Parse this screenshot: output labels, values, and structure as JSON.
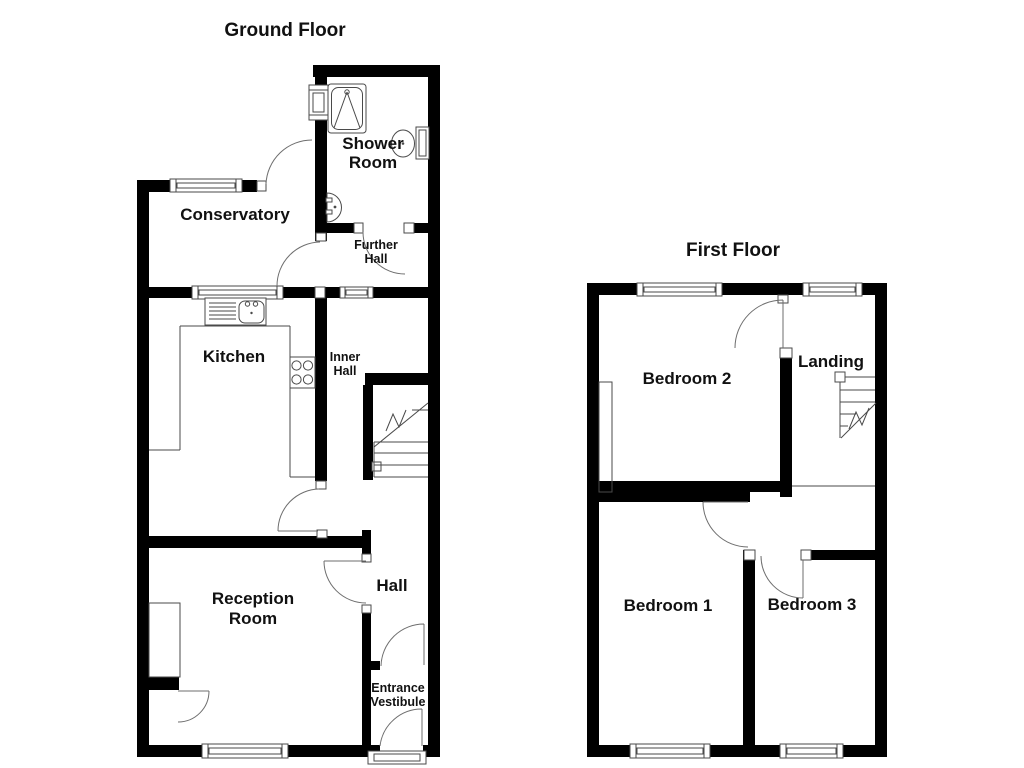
{
  "canvas": {
    "width": 1024,
    "height": 768,
    "background_color": "#ffffff",
    "wall_color": "#000000",
    "line_color": "#4a4a4a",
    "text_color": "#111111"
  },
  "floors": {
    "ground": {
      "title": "Ground Floor",
      "rooms": {
        "shower_room": {
          "line1": "Shower",
          "line2": "Room"
        },
        "conservatory": {
          "label": "Conservatory"
        },
        "further_hall": {
          "line1": "Further",
          "line2": "Hall"
        },
        "kitchen": {
          "label": "Kitchen"
        },
        "inner_hall": {
          "line1": "Inner",
          "line2": "Hall"
        },
        "hall": {
          "label": "Hall"
        },
        "reception_room": {
          "line1": "Reception",
          "line2": "Room"
        },
        "entrance_vestibule": {
          "line1": "Entrance",
          "line2": "Vestibule"
        }
      }
    },
    "first": {
      "title": "First Floor",
      "rooms": {
        "bedroom_2": {
          "label": "Bedroom 2"
        },
        "landing": {
          "label": "Landing"
        },
        "bedroom_1": {
          "label": "Bedroom 1"
        },
        "bedroom_3": {
          "label": "Bedroom 3"
        }
      }
    }
  }
}
